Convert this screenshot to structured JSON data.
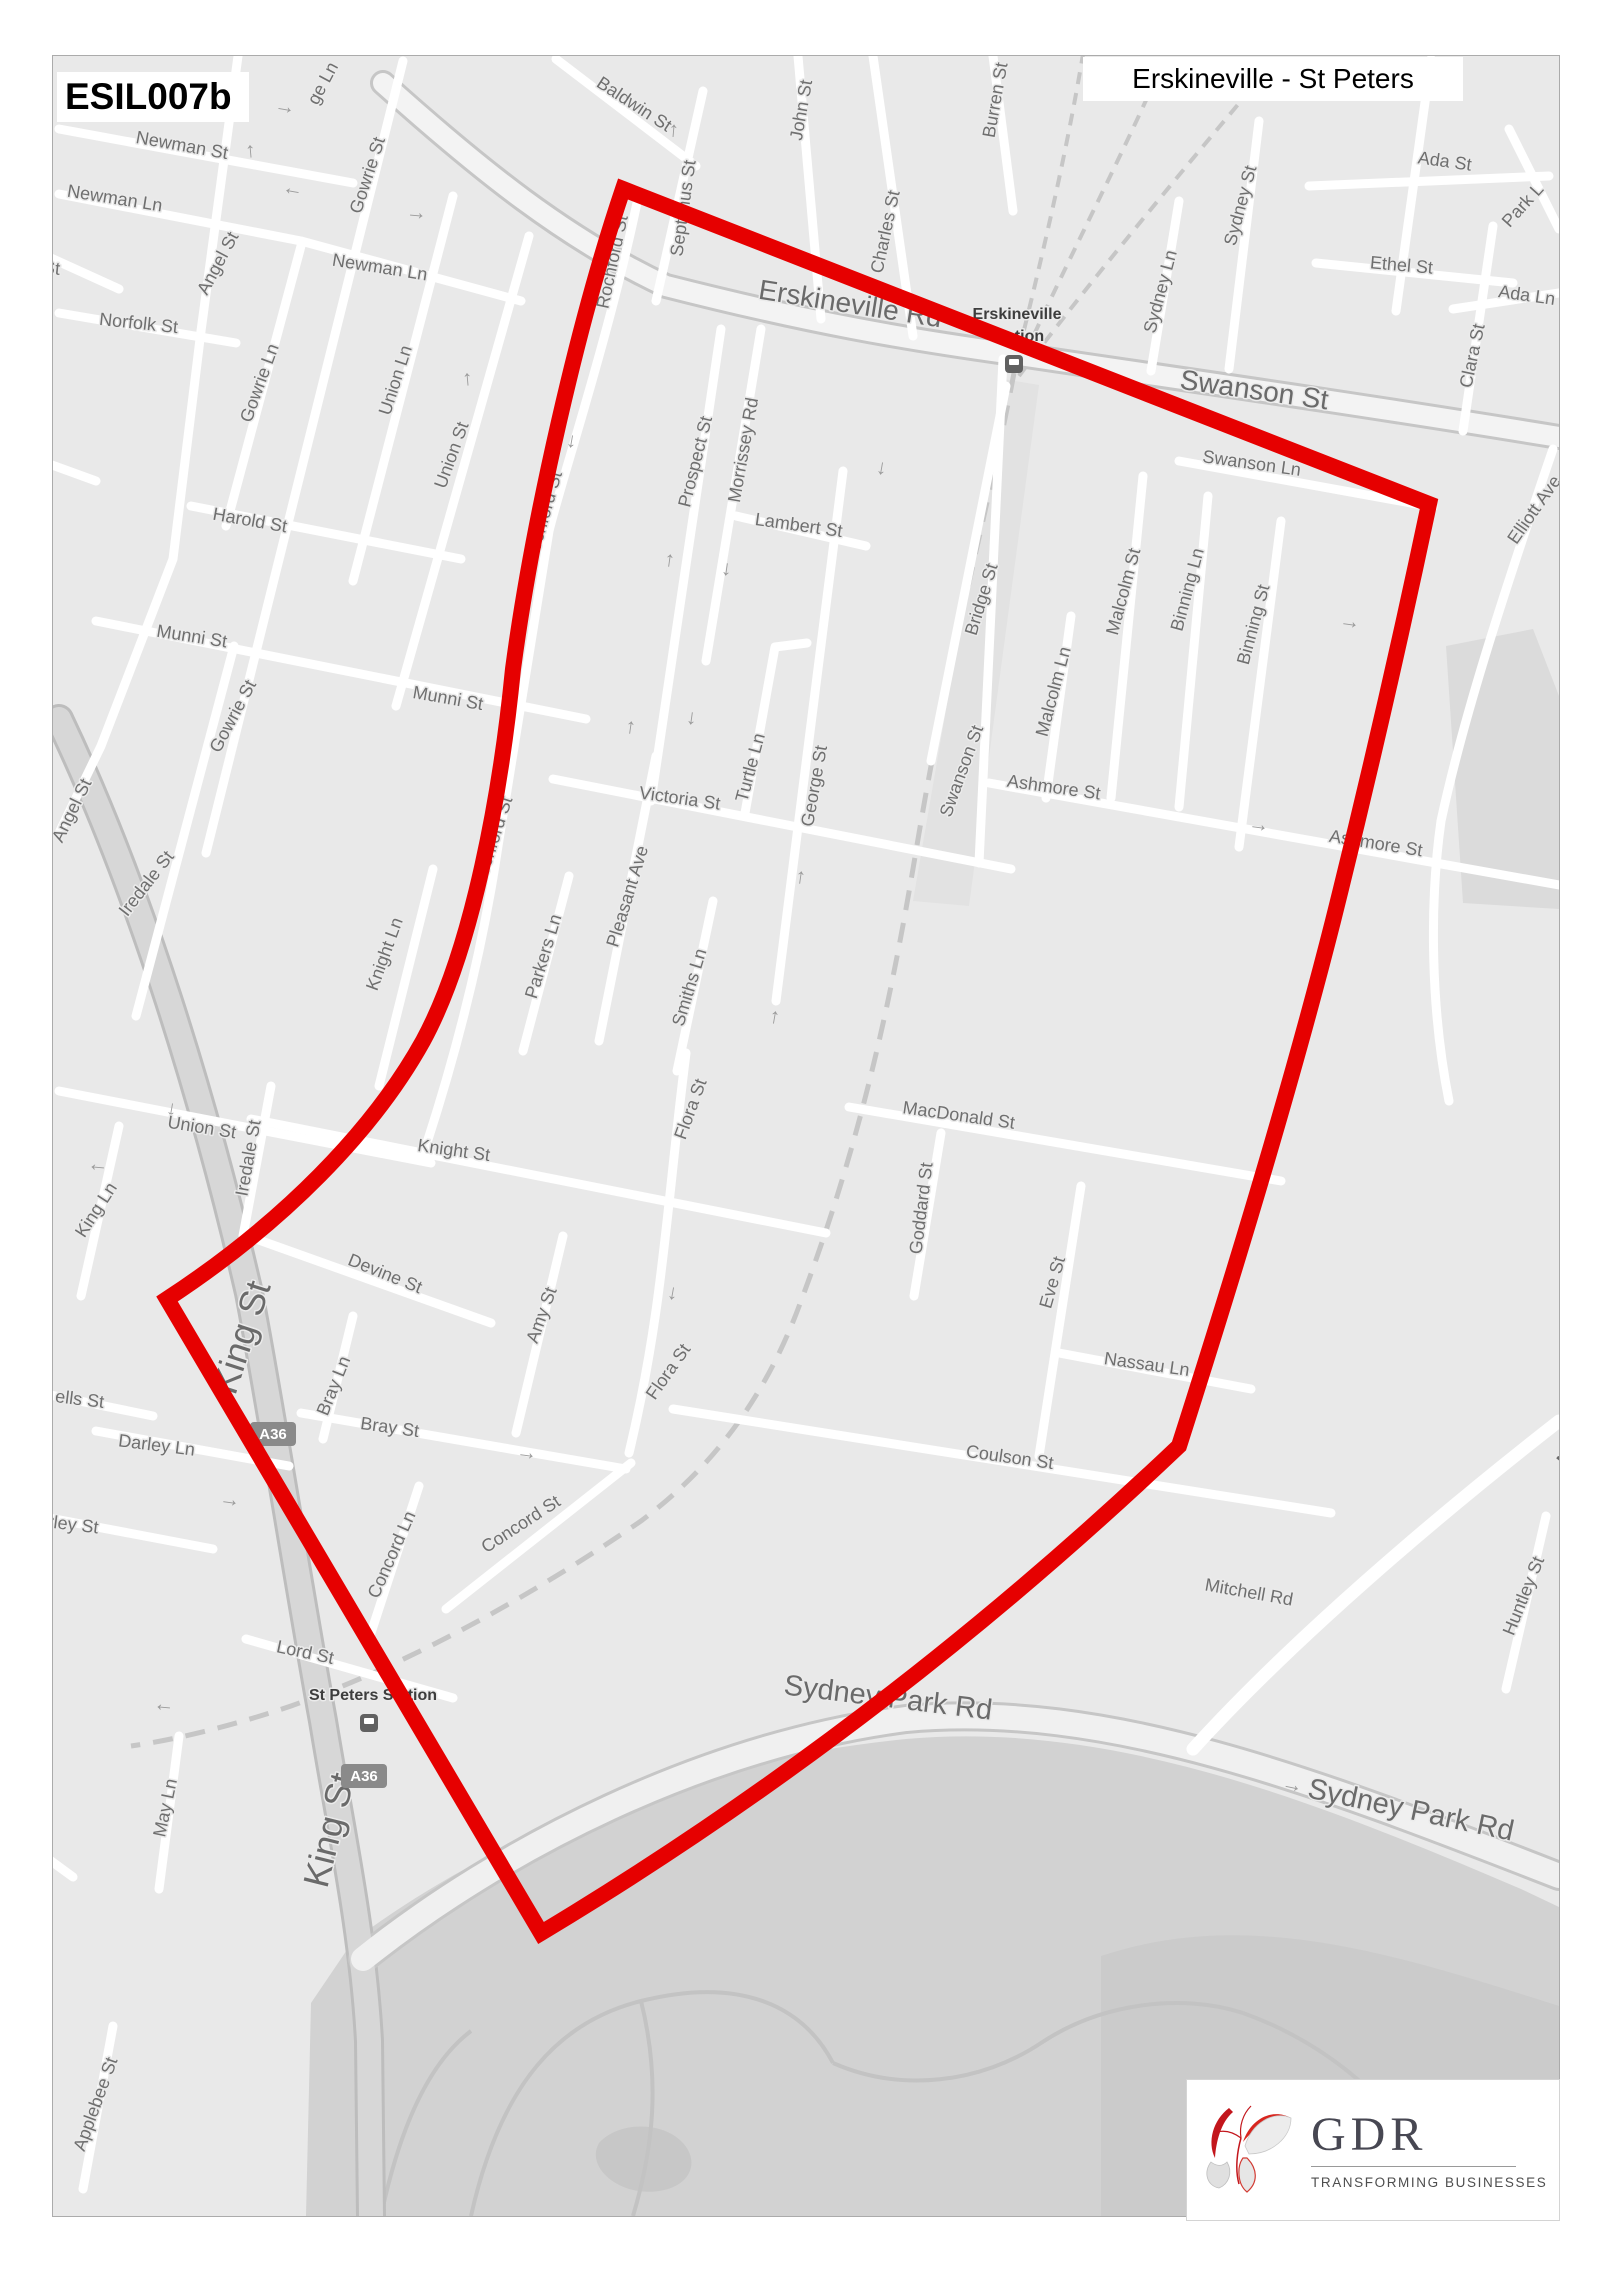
{
  "header": {
    "code": "ESIL007b",
    "title": "Erskineville - St Peters"
  },
  "logo": {
    "name": "GDR",
    "tagline": "TRANSFORMING BUSINESSES"
  },
  "map_svg": {
    "label_color": "#6f6f6f",
    "rail_color": "#c6c6c6",
    "areas": [
      {
        "name": "shaded-block",
        "d": "M1445,645 L1532,628 L1558,695 L1558,908 L1462,902 Z",
        "fill": "#dbdbdb"
      },
      {
        "name": "rail-corridor",
        "d": "M1002,378 L1038,384 L968,905 L912,900 Z",
        "fill": "#e2e2e2"
      },
      {
        "name": "sydney-park",
        "d": "M310,2002 L352,1940 C470,1852 640,1766 905,1738 C1110,1720 1310,1798 1520,1888 L1558,1906 L1558,2215 L305,2215 Z",
        "fill": "#d2d2d2"
      },
      {
        "name": "sydney-park-dark",
        "d": "M1100,1955 C1250,1905 1400,1955 1558,2005 L1558,2215 L1100,2215 Z",
        "fill": "#cbcbcb"
      },
      {
        "name": "park-pond",
        "d": "M598,2142 C618,2120 662,2120 682,2142 C700,2162 688,2186 658,2190 C618,2196 584,2166 598,2142 Z",
        "fill": "#c7c7c7"
      }
    ],
    "park_paths": [
      "M470,2215 C500,2080 560,2020 640,2000 C740,1975 802,2005 832,2062",
      "M640,2000 C660,2080 652,2148 632,2215",
      "M832,2062 C900,2092 980,2082 1040,2042 C1100,2002 1180,1992 1242,2012",
      "M380,2215 C400,2120 430,2060 470,2030",
      "M1242,2012 C1320,2040 1380,2090 1420,2150"
    ],
    "railways": [
      {
        "d": "M1013,372 C985,520 950,640 915,850 C890,1000 860,1140 800,1300 C760,1410 700,1475 640,1520 C560,1575 430,1655 290,1705 C240,1722 180,1738 130,1745",
        "dash": "20 13",
        "w": 5
      },
      {
        "d": "M1013,370 C1035,280 1065,160 1085,35",
        "dash": "12 9",
        "w": 4
      },
      {
        "d": "M1016,372 C1060,270 1125,150 1172,38",
        "dash": "12 9",
        "w": 4
      },
      {
        "d": "M1018,375 C1085,285 1185,165 1272,62",
        "dash": "12 9",
        "w": 4
      }
    ],
    "major_roads": [
      {
        "name": "king-st-road",
        "d": "M58,718 C140,890 205,1105 248,1292 C268,1395 300,1600 322,1720 C340,1830 362,1930 368,2040 L370,2215",
        "casing": "#bdbdbd",
        "cw": 30,
        "fill": "#d7d7d7",
        "fw": 24
      },
      {
        "name": "erskineville-swanson-road",
        "d": "M382,82 C480,170 565,238 665,285 C810,322 905,338 1005,352 C1160,375 1350,402 1558,436",
        "casing": "#c6c6c6",
        "cw": 26,
        "fill": "#f3f3f3",
        "fw": 20
      },
      {
        "name": "sydney-park-road",
        "d": "M362,1958 C500,1848 700,1745 905,1718 C1105,1700 1310,1778 1558,1875",
        "casing": "#c6c6c6",
        "cw": 30,
        "fill": "#f0f0f0",
        "fw": 24
      }
    ],
    "street_w": 9,
    "streets": [
      "M58,128 L352,182",
      "M58,193 L300,240 L520,300",
      "M58,312 L235,342",
      "M237,55 L200,330 L172,558 L100,745 L58,832",
      "M402,60 L205,852",
      "M300,245 L225,525",
      "M452,195 L352,580",
      "M528,235 L395,705",
      "M190,505 L460,558",
      "M95,620 L585,718",
      "M555,58 L695,165",
      "M702,90 L655,300",
      "M797,55 L820,318",
      "M872,55 L912,335",
      "M992,55 L1012,210",
      "M638,192 C610,330 560,480 548,530 C520,700 505,790 497,845 C480,960 450,1070 420,1160",
      "M720,328 L650,800",
      "M760,328 L705,660",
      "M735,515 L865,545",
      "M806,642 L774,646 L744,812",
      "M842,470 L775,1000",
      "M552,778 L1010,868",
      "M655,755 L598,1040",
      "M568,875 L522,1050",
      "M712,900 L676,1070",
      "M432,868 L378,1085",
      "M250,1118 L825,1232",
      "M58,1090 L430,1162",
      "M233,645 L135,1015",
      "M270,1085 L242,1235",
      "M118,1125 L80,1295",
      "M255,1238 L490,1322",
      "M848,1106 L1280,1180",
      "M940,1132 L913,1295",
      "M1080,1185 L1038,1455",
      "M1058,1352 L1250,1388",
      "M672,1408 L1330,1512",
      "M685,1052 C665,1210 662,1310 628,1452",
      "M562,1235 L515,1432",
      "M1002,358 L978,862",
      "M1070,615 L1045,797",
      "M1142,475 L1110,797",
      "M1207,495 L1178,806",
      "M1280,520 L1238,846",
      "M988,782 L1558,884",
      "M1178,460 L1432,506",
      "M1315,262 L1512,282",
      "M1308,185 L1548,175",
      "M1430,58 L1395,310",
      "M1452,308 L1558,292",
      "M1492,225 L1462,430",
      "M1508,128 L1558,228",
      "M1178,200 L1150,370",
      "M1258,120 L1228,368",
      "M1552,448 C1500,600 1462,718 1440,820 C1428,905 1430,1010 1448,1100",
      "M245,1638 L452,1697",
      "M300,1412 L625,1468",
      "M352,1315 L322,1438",
      "M418,1485 L368,1638",
      "M445,1608 L630,1462",
      "M30,1390 L152,1415",
      "M95,1430 L288,1465",
      "M38,1515 L212,1548",
      "M178,1735 L158,1888",
      "M112,2025 L82,2188",
      "M1545,1515 L1505,1688",
      {
        "d": "M1192,1748 C1290,1640 1430,1520 1558,1420",
        "w": 13
      },
      "M1005,385 L930,760",
      "M30,248 L118,288",
      "M18,452 L95,480",
      "M20,1838 L72,1876"
    ],
    "arrows": {
      "glyph": "→",
      "color": "#9b9b9b",
      "size": 21,
      "items": [
        [
          283,
          112,
          10
        ],
        [
          292,
          187,
          190
        ],
        [
          253,
          150,
          -95
        ],
        [
          415,
          218,
          5
        ],
        [
          470,
          378,
          -95
        ],
        [
          567,
          440,
          100
        ],
        [
          676,
          130,
          -85
        ],
        [
          633,
          727,
          -82
        ],
        [
          672,
          560,
          -82
        ],
        [
          722,
          568,
          98
        ],
        [
          877,
          467,
          100
        ],
        [
          803,
          877,
          -82
        ],
        [
          687,
          717,
          98
        ],
        [
          1348,
          627,
          8
        ],
        [
          1257,
          830,
          8
        ],
        [
          668,
          1292,
          100
        ],
        [
          777,
          1017,
          -80
        ],
        [
          525,
          1458,
          8
        ],
        [
          228,
          1505,
          8
        ],
        [
          163,
          1703,
          185
        ],
        [
          1290,
          1790,
          12
        ],
        [
          97,
          1163,
          185
        ],
        [
          167,
          1108,
          100
        ]
      ]
    },
    "labels": [
      {
        "t": "Newman St",
        "x": 180,
        "y": 150,
        "r": 10,
        "s": 18
      },
      {
        "t": "Newman Ln",
        "x": 113,
        "y": 203,
        "r": 9,
        "s": 18
      },
      {
        "t": "Newman Ln",
        "x": 378,
        "y": 272,
        "r": 9,
        "s": 18
      },
      {
        "t": "St",
        "x": 50,
        "y": 273,
        "r": 6,
        "s": 18
      },
      {
        "t": "Norfolk St",
        "x": 137,
        "y": 328,
        "r": 6,
        "s": 18
      },
      {
        "t": "Angel St",
        "x": 222,
        "y": 265,
        "r": -62,
        "s": 18
      },
      {
        "t": "Angel St",
        "x": 76,
        "y": 812,
        "r": -64,
        "s": 18
      },
      {
        "t": "ge Ln",
        "x": 327,
        "y": 85,
        "r": -62,
        "s": 18
      },
      {
        "t": "Gowrie St",
        "x": 372,
        "y": 176,
        "r": -72,
        "s": 18
      },
      {
        "t": "Gowrie Ln",
        "x": 264,
        "y": 384,
        "r": -70,
        "s": 18
      },
      {
        "t": "Gowrie St",
        "x": 237,
        "y": 718,
        "r": -62,
        "s": 18
      },
      {
        "t": "Union Ln",
        "x": 400,
        "y": 381,
        "r": -72,
        "s": 18
      },
      {
        "t": "Union St",
        "x": 456,
        "y": 456,
        "r": -70,
        "s": 18
      },
      {
        "t": "Harold St",
        "x": 248,
        "y": 525,
        "r": 10,
        "s": 18
      },
      {
        "t": "Munni St",
        "x": 190,
        "y": 641,
        "r": 9,
        "s": 18
      },
      {
        "t": "Munni St",
        "x": 446,
        "y": 703,
        "r": 10,
        "s": 18
      },
      {
        "t": "Iredale St",
        "x": 150,
        "y": 886,
        "r": -52,
        "s": 18
      },
      {
        "t": "Iredale St",
        "x": 253,
        "y": 1158,
        "r": -80,
        "s": 18
      },
      {
        "t": "n St",
        "x": 22,
        "y": 470,
        "r": 8,
        "s": 18
      },
      {
        "t": "Union St",
        "x": 200,
        "y": 1132,
        "r": 9,
        "s": 18
      },
      {
        "t": "King Ln",
        "x": 100,
        "y": 1212,
        "r": -57,
        "s": 18
      },
      {
        "t": "ells St",
        "x": 78,
        "y": 1404,
        "r": 7,
        "s": 18
      },
      {
        "t": "Darley Ln",
        "x": 155,
        "y": 1450,
        "r": 7,
        "s": 18
      },
      {
        "t": "Darley St",
        "x": 60,
        "y": 1528,
        "r": 7,
        "s": 18
      },
      {
        "t": "Baldwin St",
        "x": 630,
        "y": 108,
        "r": 33,
        "s": 18
      },
      {
        "t": "Septimus St",
        "x": 688,
        "y": 208,
        "r": -82,
        "s": 18
      },
      {
        "t": "John St",
        "x": 806,
        "y": 110,
        "r": -80,
        "s": 18
      },
      {
        "t": "Charles St",
        "x": 890,
        "y": 232,
        "r": -78,
        "s": 18
      },
      {
        "t": "Burren St",
        "x": 1000,
        "y": 100,
        "r": -80,
        "s": 18
      },
      {
        "t": "Erskineville Rd",
        "x": 848,
        "y": 312,
        "r": 9,
        "s": 28,
        "c": "#6a6a6a"
      },
      {
        "t": "Swanson St",
        "x": 1252,
        "y": 398,
        "r": 8,
        "s": 28,
        "c": "#6a6a6a"
      },
      {
        "t": "Swanson Ln",
        "x": 1250,
        "y": 468,
        "r": 8,
        "s": 18
      },
      {
        "t": "Sydney Ln",
        "x": 1165,
        "y": 292,
        "r": -75,
        "s": 18
      },
      {
        "t": "Sydney St",
        "x": 1245,
        "y": 206,
        "r": -75,
        "s": 18
      },
      {
        "t": "Ada St",
        "x": 1443,
        "y": 166,
        "r": 8,
        "s": 18
      },
      {
        "t": "Ethel St",
        "x": 1400,
        "y": 270,
        "r": 5,
        "s": 18
      },
      {
        "t": "Ada Ln",
        "x": 1525,
        "y": 300,
        "r": 8,
        "s": 18
      },
      {
        "t": "Clara St",
        "x": 1477,
        "y": 356,
        "r": -78,
        "s": 18
      },
      {
        "t": "Park L",
        "x": 1526,
        "y": 208,
        "r": -48,
        "s": 18
      },
      {
        "t": "Elliott Ave",
        "x": 1538,
        "y": 512,
        "r": -55,
        "s": 18
      },
      {
        "t": "Rochford St",
        "x": 617,
        "y": 262,
        "r": -78,
        "s": 18
      },
      {
        "t": "Rochford St",
        "x": 548,
        "y": 518,
        "r": -74,
        "s": 18
      },
      {
        "t": "Rochford St",
        "x": 497,
        "y": 843,
        "r": -72,
        "s": 18
      },
      {
        "t": "Prospect St",
        "x": 700,
        "y": 462,
        "r": -76,
        "s": 18
      },
      {
        "t": "Morrissey Rd",
        "x": 748,
        "y": 450,
        "r": -80,
        "s": 18
      },
      {
        "t": "Lambert St",
        "x": 797,
        "y": 530,
        "r": 8,
        "s": 18
      },
      {
        "t": "Victoria St",
        "x": 678,
        "y": 803,
        "r": 8,
        "s": 18
      },
      {
        "t": "Turtle Ln",
        "x": 755,
        "y": 768,
        "r": -75,
        "s": 18
      },
      {
        "t": "George St",
        "x": 819,
        "y": 786,
        "r": -80,
        "s": 18
      },
      {
        "t": "Pleasant Ave",
        "x": 632,
        "y": 897,
        "r": -73,
        "s": 18
      },
      {
        "t": "Parkers Ln",
        "x": 548,
        "y": 957,
        "r": -73,
        "s": 18
      },
      {
        "t": "Smiths Ln",
        "x": 694,
        "y": 988,
        "r": -73,
        "s": 18
      },
      {
        "t": "Flora St",
        "x": 695,
        "y": 1110,
        "r": -70,
        "s": 18
      },
      {
        "t": "Flora St",
        "x": 672,
        "y": 1374,
        "r": -55,
        "s": 18
      },
      {
        "t": "Knight Ln",
        "x": 389,
        "y": 955,
        "r": -70,
        "s": 18
      },
      {
        "t": "Knight St",
        "x": 452,
        "y": 1155,
        "r": 8,
        "s": 18
      },
      {
        "t": "Devine St",
        "x": 382,
        "y": 1278,
        "r": 22,
        "s": 18
      },
      {
        "t": "Amy St",
        "x": 546,
        "y": 1316,
        "r": -70,
        "s": 18
      },
      {
        "t": "Bridge St",
        "x": 986,
        "y": 600,
        "r": -73,
        "s": 18
      },
      {
        "t": "Swanson St",
        "x": 966,
        "y": 772,
        "r": -70,
        "s": 18
      },
      {
        "t": "Malcolm Ln",
        "x": 1058,
        "y": 692,
        "r": -75,
        "s": 18
      },
      {
        "t": "Malcolm St",
        "x": 1128,
        "y": 592,
        "r": -75,
        "s": 18
      },
      {
        "t": "Binning Ln",
        "x": 1192,
        "y": 590,
        "r": -75,
        "s": 18
      },
      {
        "t": "Binning St",
        "x": 1258,
        "y": 625,
        "r": -75,
        "s": 18
      },
      {
        "t": "Ashmore St",
        "x": 1052,
        "y": 792,
        "r": 8,
        "s": 18
      },
      {
        "t": "Ashmore St",
        "x": 1374,
        "y": 848,
        "r": 9,
        "s": 18
      },
      {
        "t": "MacDonald St",
        "x": 957,
        "y": 1120,
        "r": 8,
        "s": 18
      },
      {
        "t": "Goddard St",
        "x": 926,
        "y": 1208,
        "r": -83,
        "s": 18
      },
      {
        "t": "Eve St",
        "x": 1057,
        "y": 1283,
        "r": -74,
        "s": 18
      },
      {
        "t": "Nassau Ln",
        "x": 1145,
        "y": 1369,
        "r": 8,
        "s": 18
      },
      {
        "t": "Coulson St",
        "x": 1008,
        "y": 1462,
        "r": 8,
        "s": 18
      },
      {
        "t": "Bray Ln",
        "x": 338,
        "y": 1387,
        "r": -68,
        "s": 18
      },
      {
        "t": "Bray St",
        "x": 388,
        "y": 1432,
        "r": 8,
        "s": 18
      },
      {
        "t": "Concord Ln",
        "x": 396,
        "y": 1556,
        "r": -66,
        "s": 18
      },
      {
        "t": "Concord St",
        "x": 523,
        "y": 1528,
        "r": -33,
        "s": 18
      },
      {
        "t": "Lord St",
        "x": 303,
        "y": 1657,
        "r": 12,
        "s": 18
      },
      {
        "t": "May Ln",
        "x": 170,
        "y": 1808,
        "r": -78,
        "s": 18
      },
      {
        "t": "y Ln",
        "x": 28,
        "y": 1852,
        "r": -50,
        "s": 18
      },
      {
        "t": "Applebee St",
        "x": 100,
        "y": 2105,
        "r": -70,
        "s": 18
      },
      {
        "t": "King St",
        "x": 252,
        "y": 1340,
        "r": -72,
        "s": 36,
        "c": "#6a6a6a"
      },
      {
        "t": "King St",
        "x": 340,
        "y": 1832,
        "r": -76,
        "s": 36,
        "c": "#6a6a6a"
      },
      {
        "t": "Sydney Park Rd",
        "x": 886,
        "y": 1706,
        "r": 7,
        "s": 29,
        "c": "#6a6a6a"
      },
      {
        "t": "Sydney Park Rd",
        "x": 1408,
        "y": 1818,
        "r": 12,
        "s": 29,
        "c": "#6a6a6a"
      },
      {
        "t": "Mitchell Rd",
        "x": 1247,
        "y": 1597,
        "r": 10,
        "s": 18
      },
      {
        "t": "Huntley St",
        "x": 1528,
        "y": 1597,
        "r": -68,
        "s": 18
      },
      {
        "t": "Mitchell",
        "x": 1592,
        "y": 1437,
        "r": -52,
        "s": 24,
        "c": "#6a6a6a"
      },
      {
        "t": "Erskineville",
        "x": 1016,
        "y": 318,
        "r": 0,
        "s": 16,
        "c": "#3d3d3d",
        "w": 600
      },
      {
        "t": "Station",
        "x": 1016,
        "y": 340,
        "r": 0,
        "s": 16,
        "c": "#3d3d3d",
        "w": 600
      },
      {
        "t": "St Peters Station",
        "x": 372,
        "y": 1699,
        "r": 0,
        "s": 16,
        "c": "#3d3d3d",
        "w": 600
      }
    ],
    "badges": {
      "fill": "#8a8a8a",
      "text_color": "#ffffff",
      "items": [
        [
          272,
          1433,
          "A36"
        ],
        [
          363,
          1775,
          "A36"
        ]
      ]
    },
    "stations": [
      [
        1013,
        363
      ],
      [
        368,
        1722
      ]
    ],
    "boundary": {
      "color": "#e60000",
      "w": 16,
      "d": "M622,188 L1428,503 C1405,612 1372,760 1332,920 C1296,1062 1242,1245 1178,1445 Q880,1728 540,1932 L166,1298 C282,1222 372,1130 422,1040 C472,948 500,790 512,668 C532,518 578,318 622,188 Z"
    }
  }
}
